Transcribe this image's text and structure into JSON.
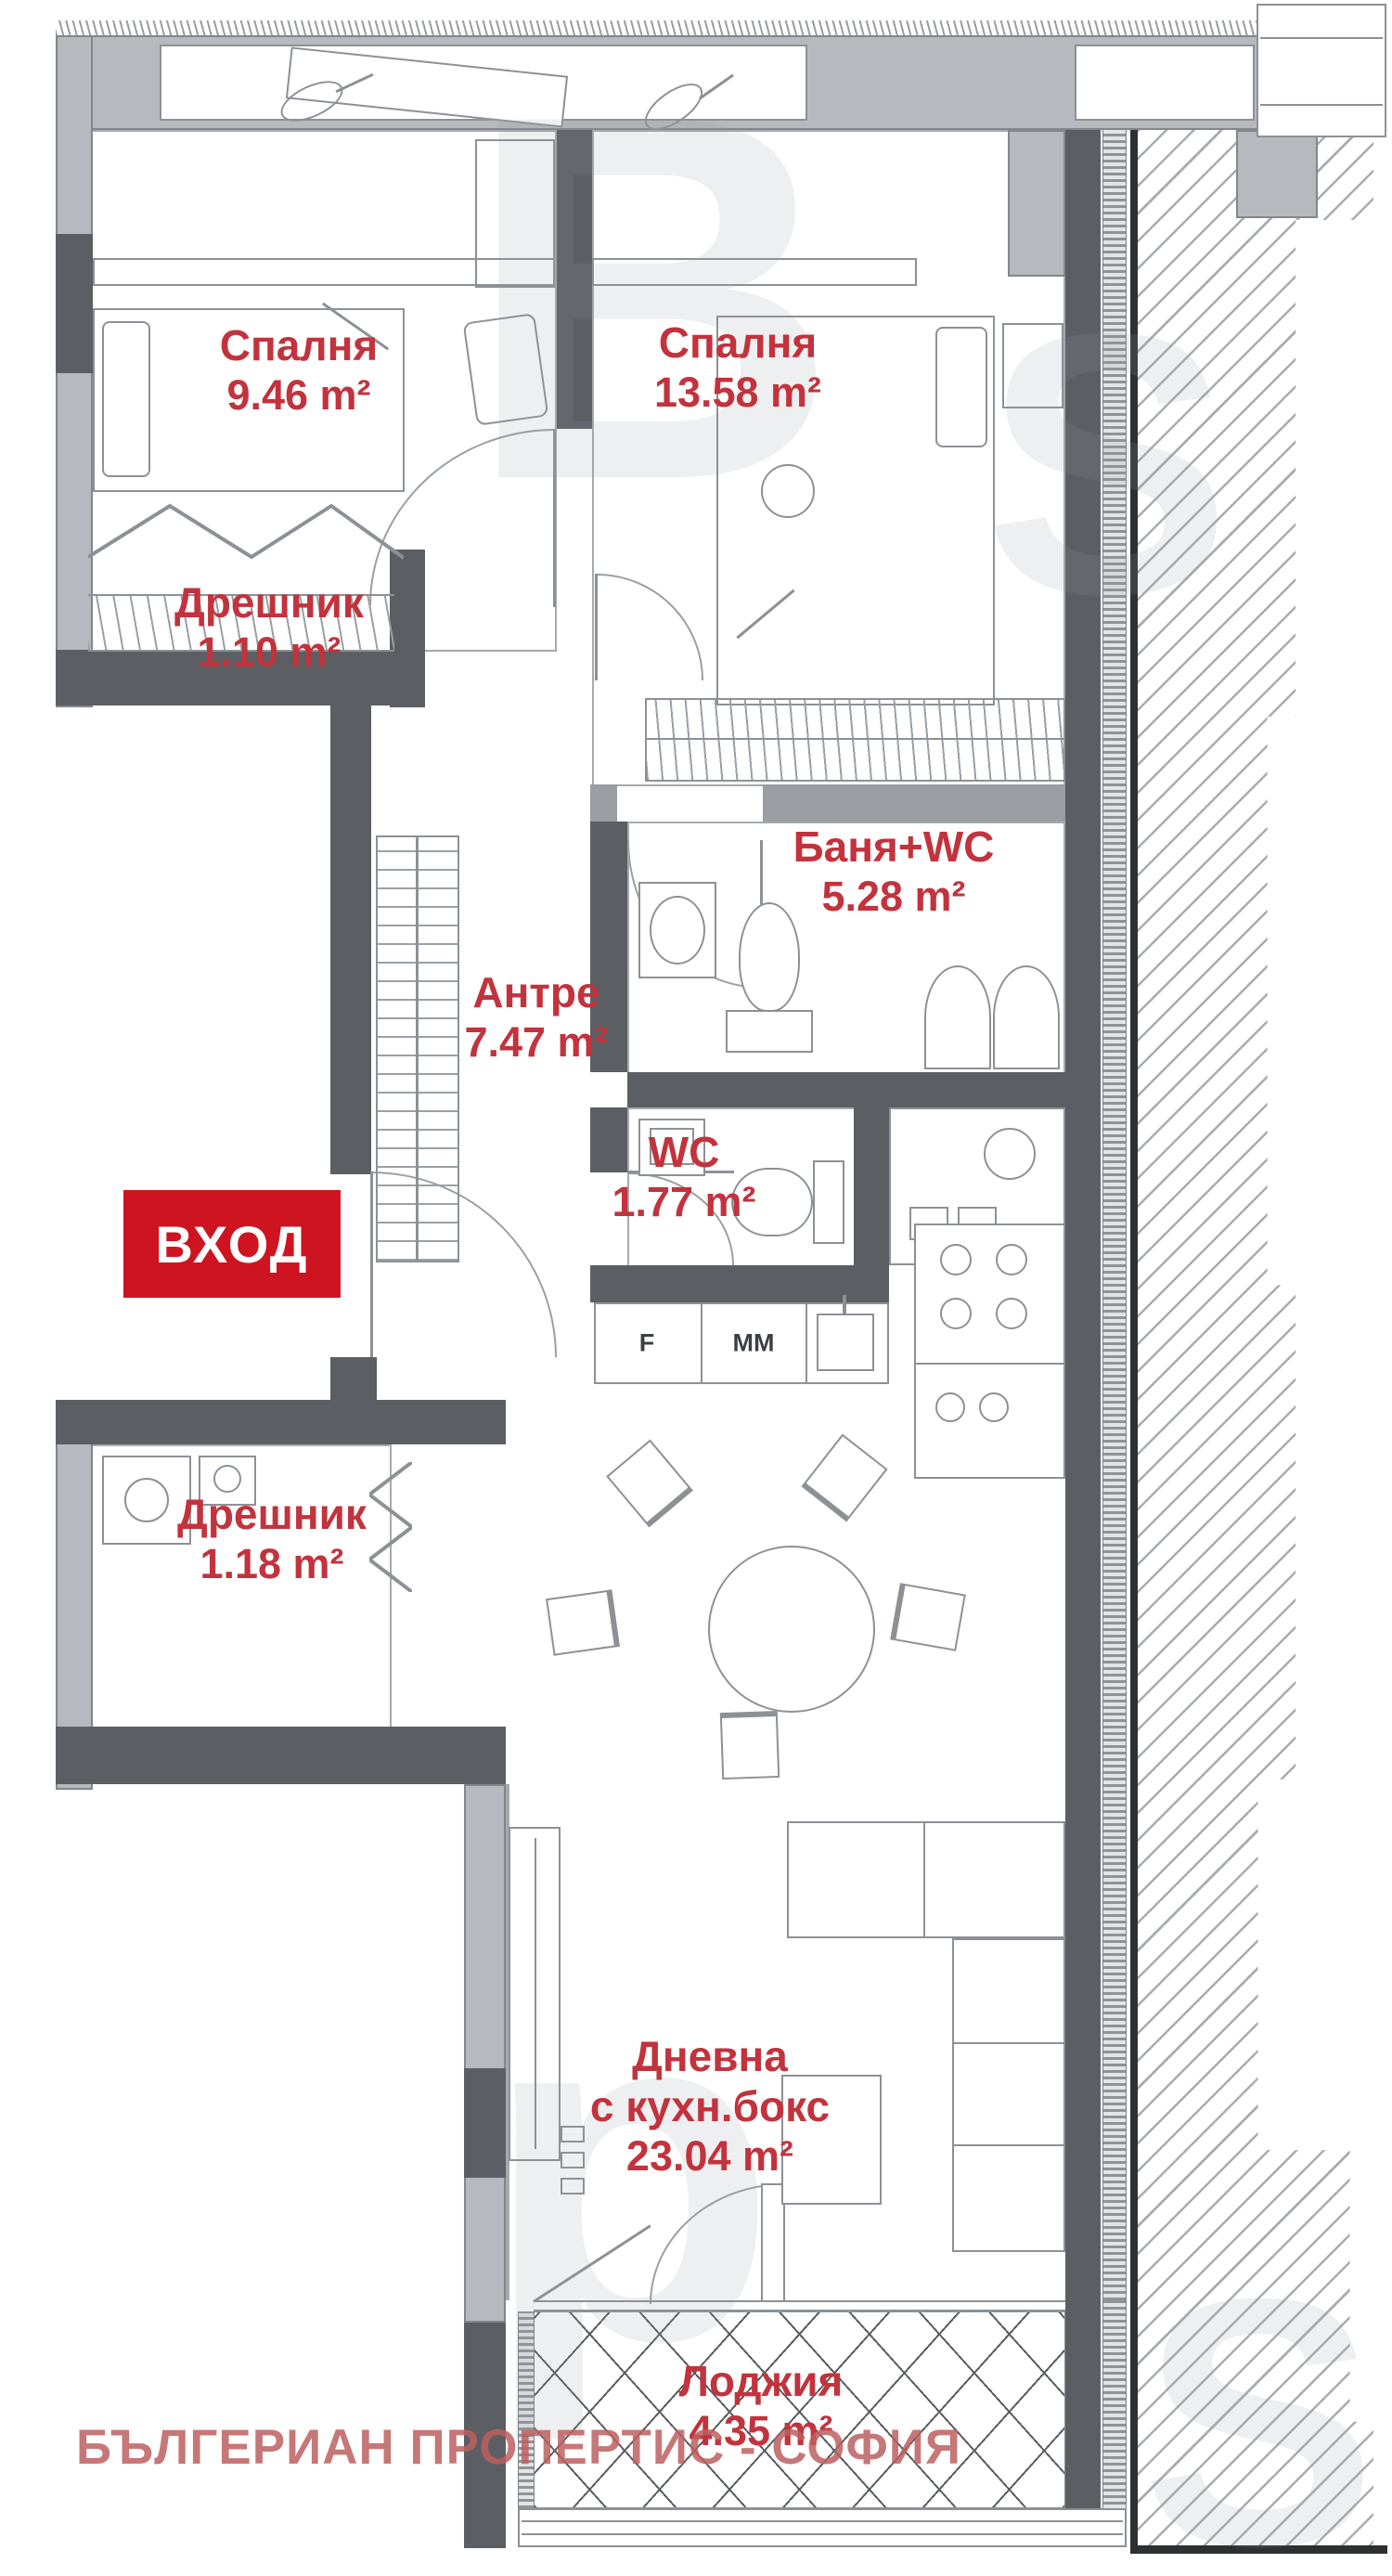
{
  "plan": {
    "rooms": [
      {
        "name": "Спалня",
        "area": "9.46 m²"
      },
      {
        "name": "Спалня",
        "area": "13.58 m²"
      },
      {
        "name": "Дрешник",
        "area": "1.10 m²"
      },
      {
        "name": "Антре",
        "area": "7.47 m²"
      },
      {
        "name": "Баня+WC",
        "area": "5.28 m²"
      },
      {
        "name": "WC",
        "area": "1.77 m²"
      },
      {
        "name": "Дрешник",
        "area": "1.18 m²"
      },
      {
        "name_line1": "Дневна",
        "name_line2": "с кухн.бокс",
        "area": "23.04 m²"
      },
      {
        "name": "Лоджия",
        "area": "4.35 m²"
      }
    ],
    "entrance_label": "ВХОД",
    "kitchen_units": [
      "F",
      "MM"
    ],
    "watermark_text": "БЪЛГЕРИАН ПРОПЕРТИС - СОФИЯ",
    "watermark_letters": [
      "B",
      "S",
      "p",
      "S"
    ],
    "colors": {
      "label_red": "#c2333d",
      "badge_red": "#ce1420",
      "wall_dark": "#5b5e63",
      "wall_light": "#b6b9bd"
    }
  }
}
